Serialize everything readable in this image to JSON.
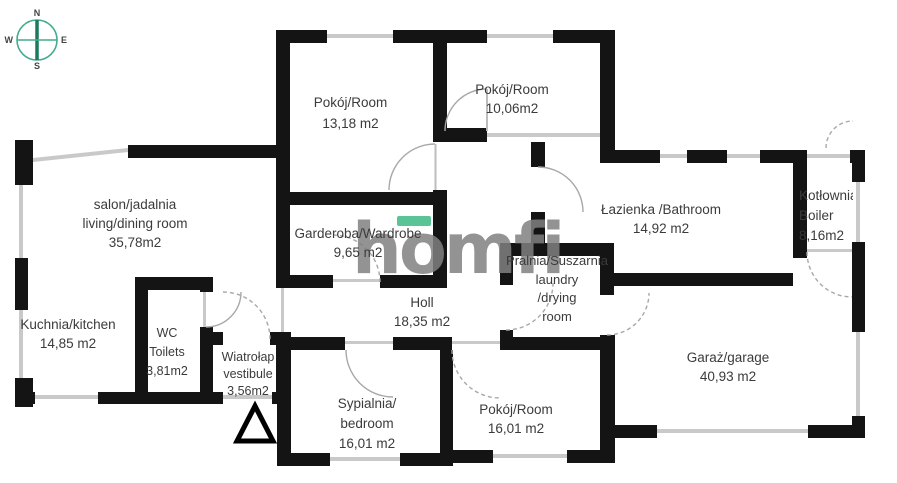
{
  "compass": {
    "n": "N",
    "e": "E",
    "s": "S",
    "w": "W"
  },
  "watermark": {
    "text": "homfi",
    "accent_color": "#5BC497"
  },
  "colors": {
    "wall": "#141414",
    "window": "#c9c9c9",
    "arc": "#a8a8a8",
    "text": "#3b3b3b",
    "compass_ring": "#44ab8e",
    "compass_needle": "#187a5e"
  },
  "rooms": {
    "salon": {
      "line1": "salon/jadalnia",
      "line2": "living/dining room",
      "line3": "35,78m2"
    },
    "kuchnia": {
      "line1": "Kuchnia/kitchen",
      "line2": "14,85 m2"
    },
    "wc": {
      "line1": "WC",
      "line2": "Toilets",
      "line3": "3,81m2"
    },
    "wiatrolap": {
      "line1": "Wiatrołap",
      "line2": "vestibule",
      "line3": "3,56m2"
    },
    "pokoj_13": {
      "line1": "Pokój/Room",
      "line2": "13,18 m2"
    },
    "pokoj_10": {
      "line1": "Pokój/Room",
      "line2": "10,06m2"
    },
    "garderoba": {
      "line1": "Garderoba/Wardrobe",
      "line2": "9,65 m2"
    },
    "holl": {
      "line1": "Holl",
      "line2": "18,35 m2"
    },
    "pralnia": {
      "line1": "Pralnia/Suszarnia",
      "line2": "laundry",
      "line3": "/drying",
      "line4": "room"
    },
    "lazienka": {
      "line1": "Łazienka /Bathroom",
      "line2": "14,92 m2"
    },
    "kotlownia": {
      "line1": "Kotłownia",
      "line2": "Boiler",
      "line3": "8,16m2"
    },
    "garaz": {
      "line1": "Garaż/garage",
      "line2": "40,93 m2"
    },
    "sypialnia": {
      "line1": "Sypialnia/",
      "line2": "bedroom",
      "line3": "16,01 m2"
    },
    "pokoj_16": {
      "line1": "Pokój/Room",
      "line2": "16,01 m2"
    }
  }
}
